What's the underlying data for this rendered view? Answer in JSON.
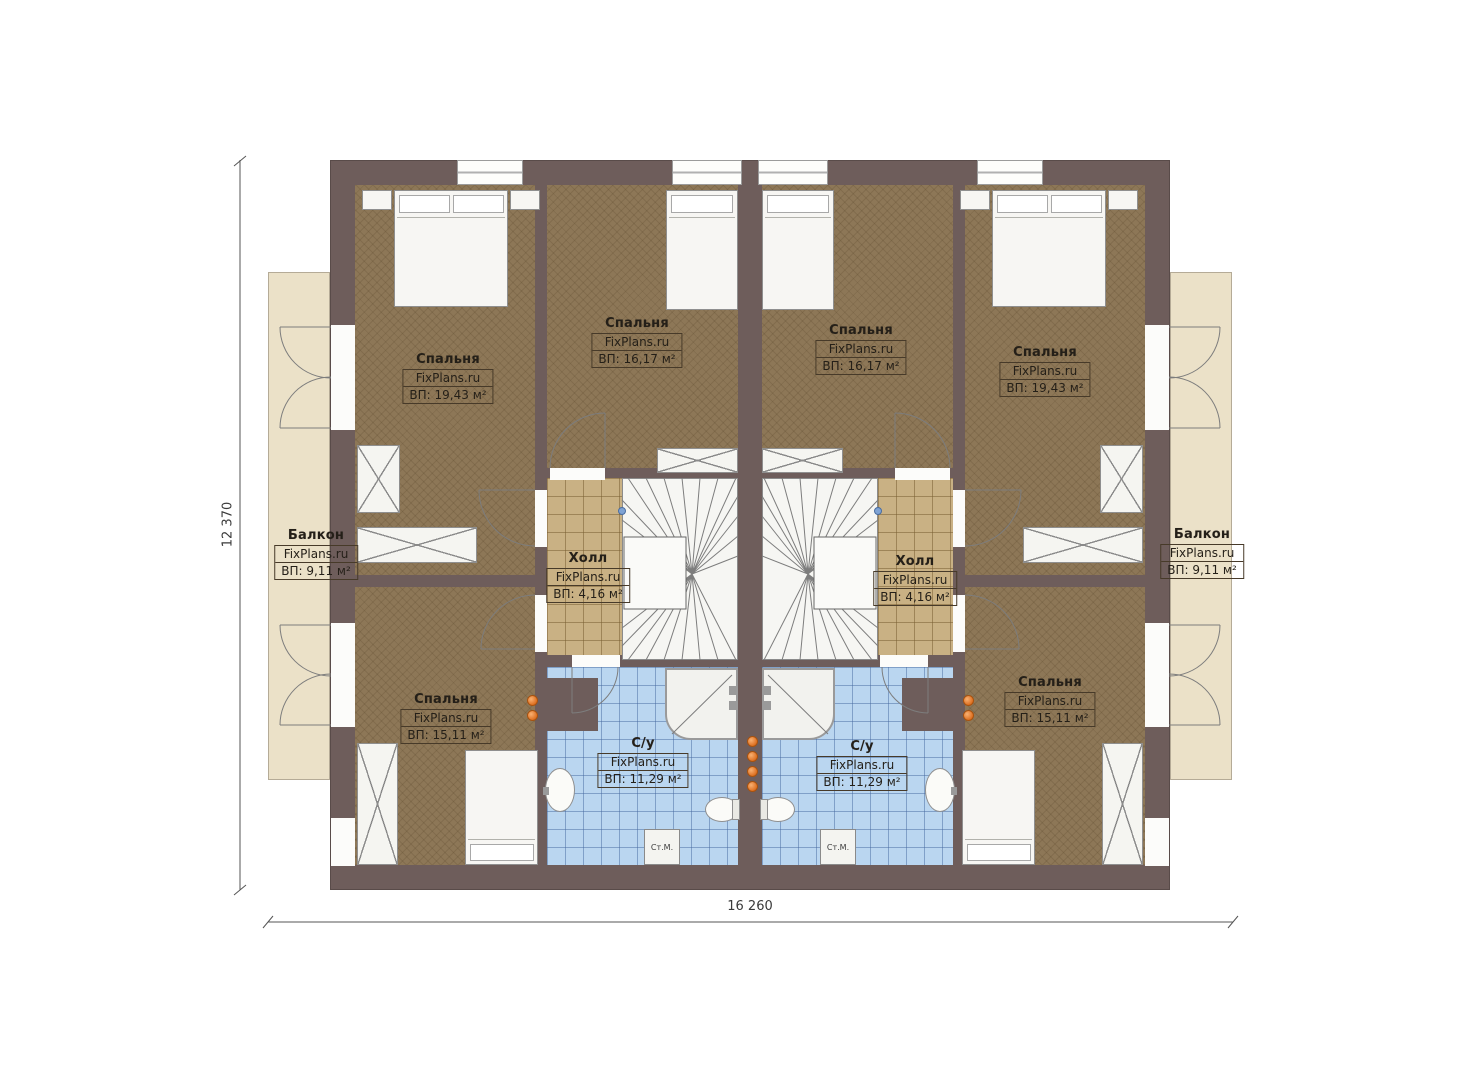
{
  "plan": {
    "watermark": "FixPlans.ru",
    "washer_label": "Ст.М.",
    "dimensions": {
      "width_label": "16 260",
      "height_label": "12 370"
    },
    "rooms": {
      "bedroom_top_left": {
        "name": "Спальня",
        "area": "ВП: 19,43 м²"
      },
      "bedroom_mid_left": {
        "name": "Спальня",
        "area": "ВП: 16,17 м²"
      },
      "bedroom_mid_right": {
        "name": "Спальня",
        "area": "ВП: 16,17 м²"
      },
      "bedroom_top_right": {
        "name": "Спальня",
        "area": "ВП: 19,43 м²"
      },
      "balcony_left": {
        "name": "Балкон",
        "area": "ВП: 9,11 м²"
      },
      "balcony_right": {
        "name": "Балкон",
        "area": "ВП: 9,11 м²"
      },
      "hall_left": {
        "name": "Холл",
        "area": "ВП: 4,16 м²"
      },
      "hall_right": {
        "name": "Холл",
        "area": "ВП: 4,16 м²"
      },
      "bedroom_bottom_left": {
        "name": "Спальня",
        "area": "ВП: 15,11 м²"
      },
      "bedroom_bottom_right": {
        "name": "Спальня",
        "area": "ВП: 15,11 м²"
      },
      "bathroom_left": {
        "name": "С/у",
        "area": "ВП: 11,29 м²"
      },
      "bathroom_right": {
        "name": "С/у",
        "area": "ВП: 11,29 м²"
      }
    },
    "colors": {
      "wall": "#6e5d5b",
      "bedroom_floor": "#8d7757",
      "hall_floor": "#c9b184",
      "bath_floor": "#bad6f0",
      "balcony_floor": "#ebe1c8",
      "furniture": "#f7f6f3",
      "accent_orange": "#e0762c",
      "text": "#241f18"
    }
  }
}
